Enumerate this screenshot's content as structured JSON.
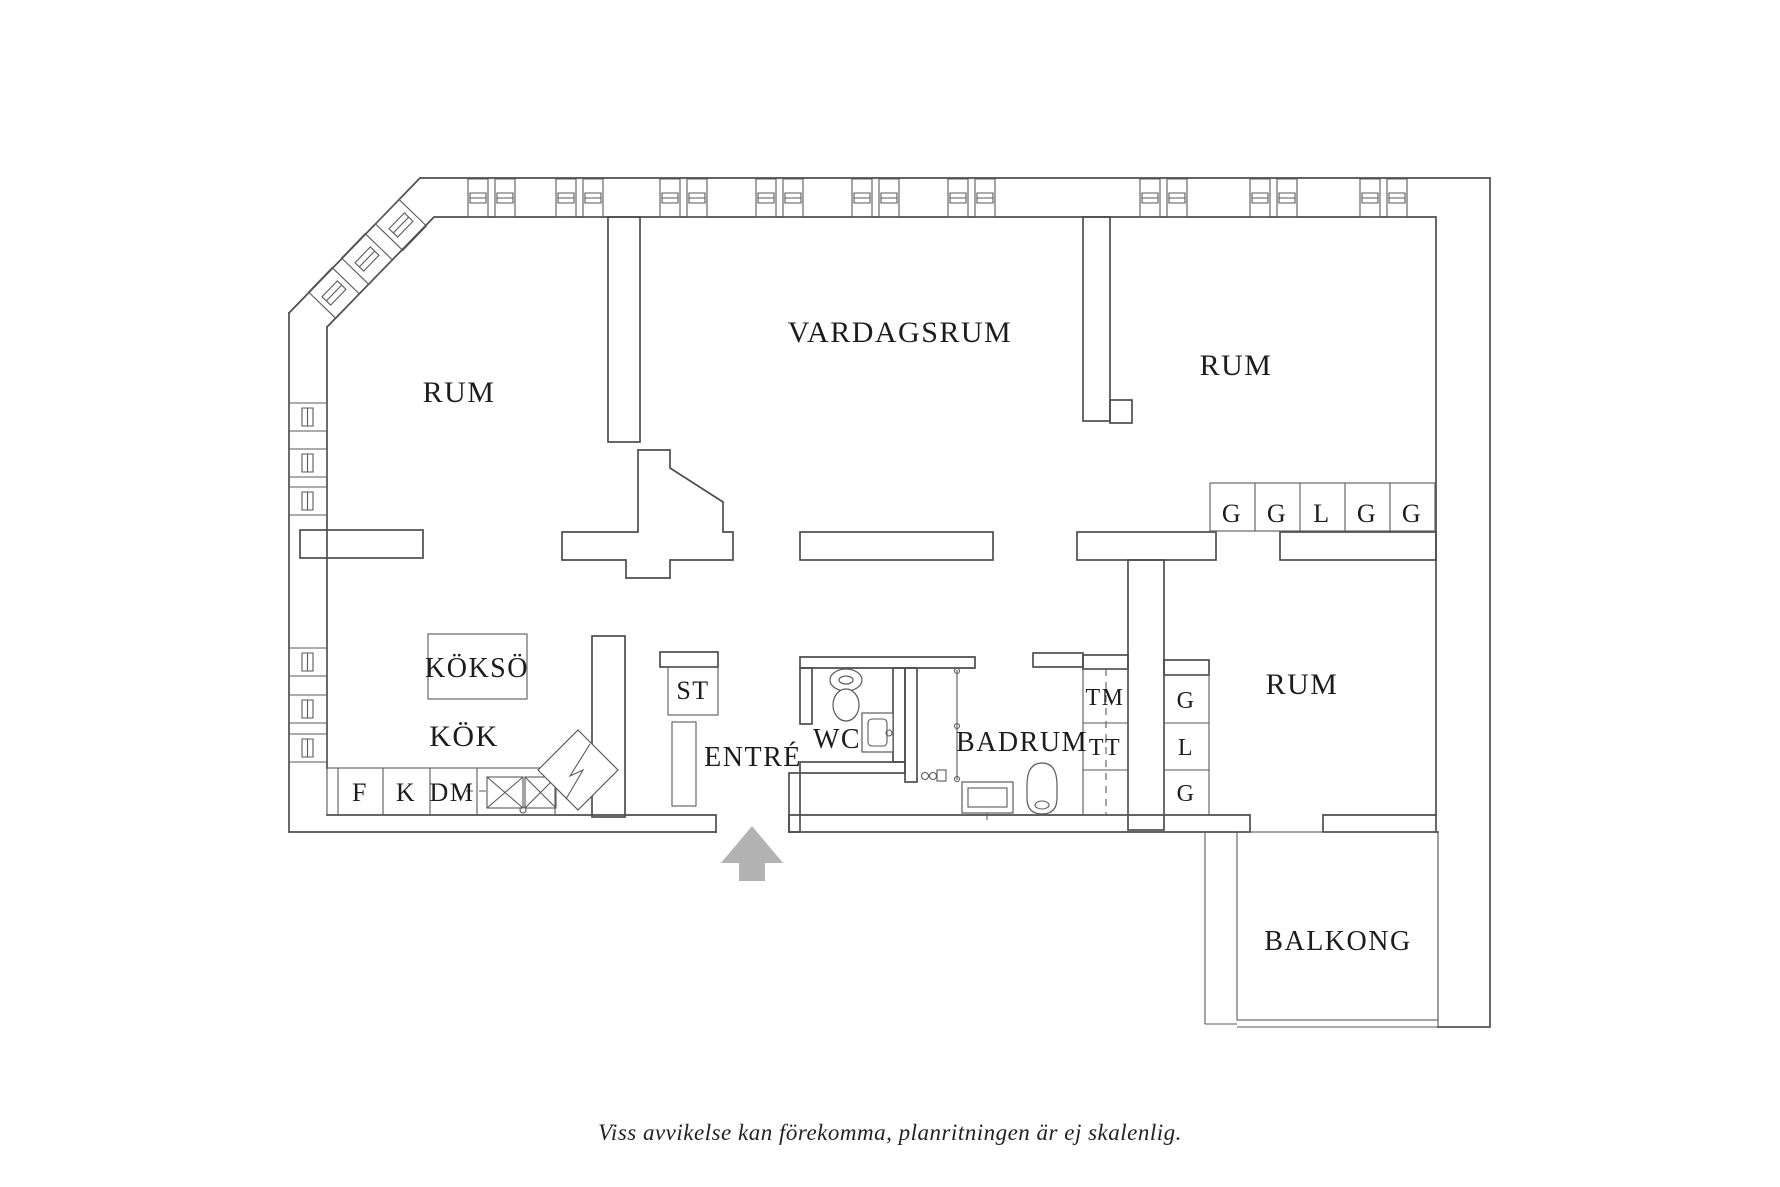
{
  "plan": {
    "rooms": {
      "room_top_left": "RUM",
      "living_room": "VARDAGSRUM",
      "room_top_right": "RUM",
      "kitchen": "KÖK",
      "kitchen_island": "KÖKSÖ",
      "closet_st": "ST",
      "entrance": "ENTRÉ",
      "toilet": "WC",
      "bathroom": "BADRUM",
      "room_bottom_right": "RUM",
      "balcony": "BALKONG"
    },
    "appliances": {
      "fridge": "F",
      "freezer": "K",
      "dishwasher": "DM",
      "washing_machine": "TM",
      "tumble_dryer": "TT"
    },
    "wardrobes_top_right": [
      "G",
      "G",
      "L",
      "G",
      "G"
    ],
    "wardrobes_hall": [
      "G",
      "L",
      "G"
    ],
    "arrow_color": "#b3b3b3",
    "line_color": "#4d4d4d"
  },
  "caption": "Viss avvikelse kan förekomma, planritningen är ej skalenlig."
}
